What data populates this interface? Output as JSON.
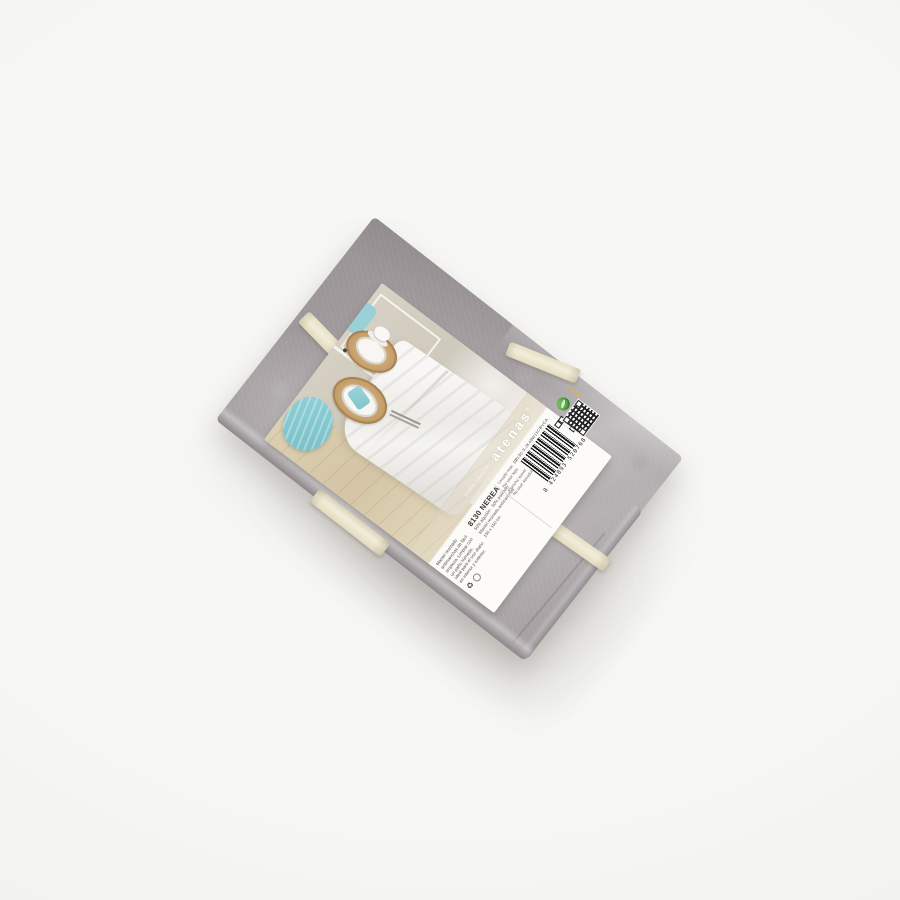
{
  "scene": {
    "type": "product-photo",
    "background_color": "#f5f5f3",
    "subject": "Folded grey jacquard tablecloth tied with two cream ribbons and a wrap-around paper label"
  },
  "cloth": {
    "base_color": "#a49ea1",
    "highlight_color": "#c6c2c3",
    "shadow_color": "#8e888b",
    "ribbon_color": "#f0ead5"
  },
  "label": {
    "brand": "atenas",
    "brand_mark": "®",
    "tagline": "home textile",
    "title": "8130 NEREA",
    "subtitle_lines": [
      "50% algodón · 50% poliéster",
      "Mantel resinado antimanchas",
      "150 x 150 cm"
    ],
    "care_lines": [
      "Lavado máx. 30°",
      "No usar lejía",
      "Plancha suave",
      "No usar secadora"
    ],
    "description": "Mantel resinado antimanchas de fácil limpieza. Limpiar con un paño húmedo. Ideal para el uso diario en interior y exterior.",
    "product_code": "8130-3-JK48W15CBVCA",
    "barcode_digits": "8 424893 520768",
    "recycle_symbol": "♻",
    "green_dot_color": "#4f9e3d",
    "gold_seal_color": "#c59a3f"
  },
  "label_photo": {
    "description": "Dining table with white tablecloth, cork placemats, white plates and cup, turquoise napkins and a pleated turquoise cushion on a light wooden floor",
    "wall_color": "#d6cfc2",
    "tablecloth_color": "#f5f4f1",
    "floor_color": "#d8cbae",
    "placemat_color": "#c49f6e",
    "accent_color": "#8ed0d6"
  }
}
